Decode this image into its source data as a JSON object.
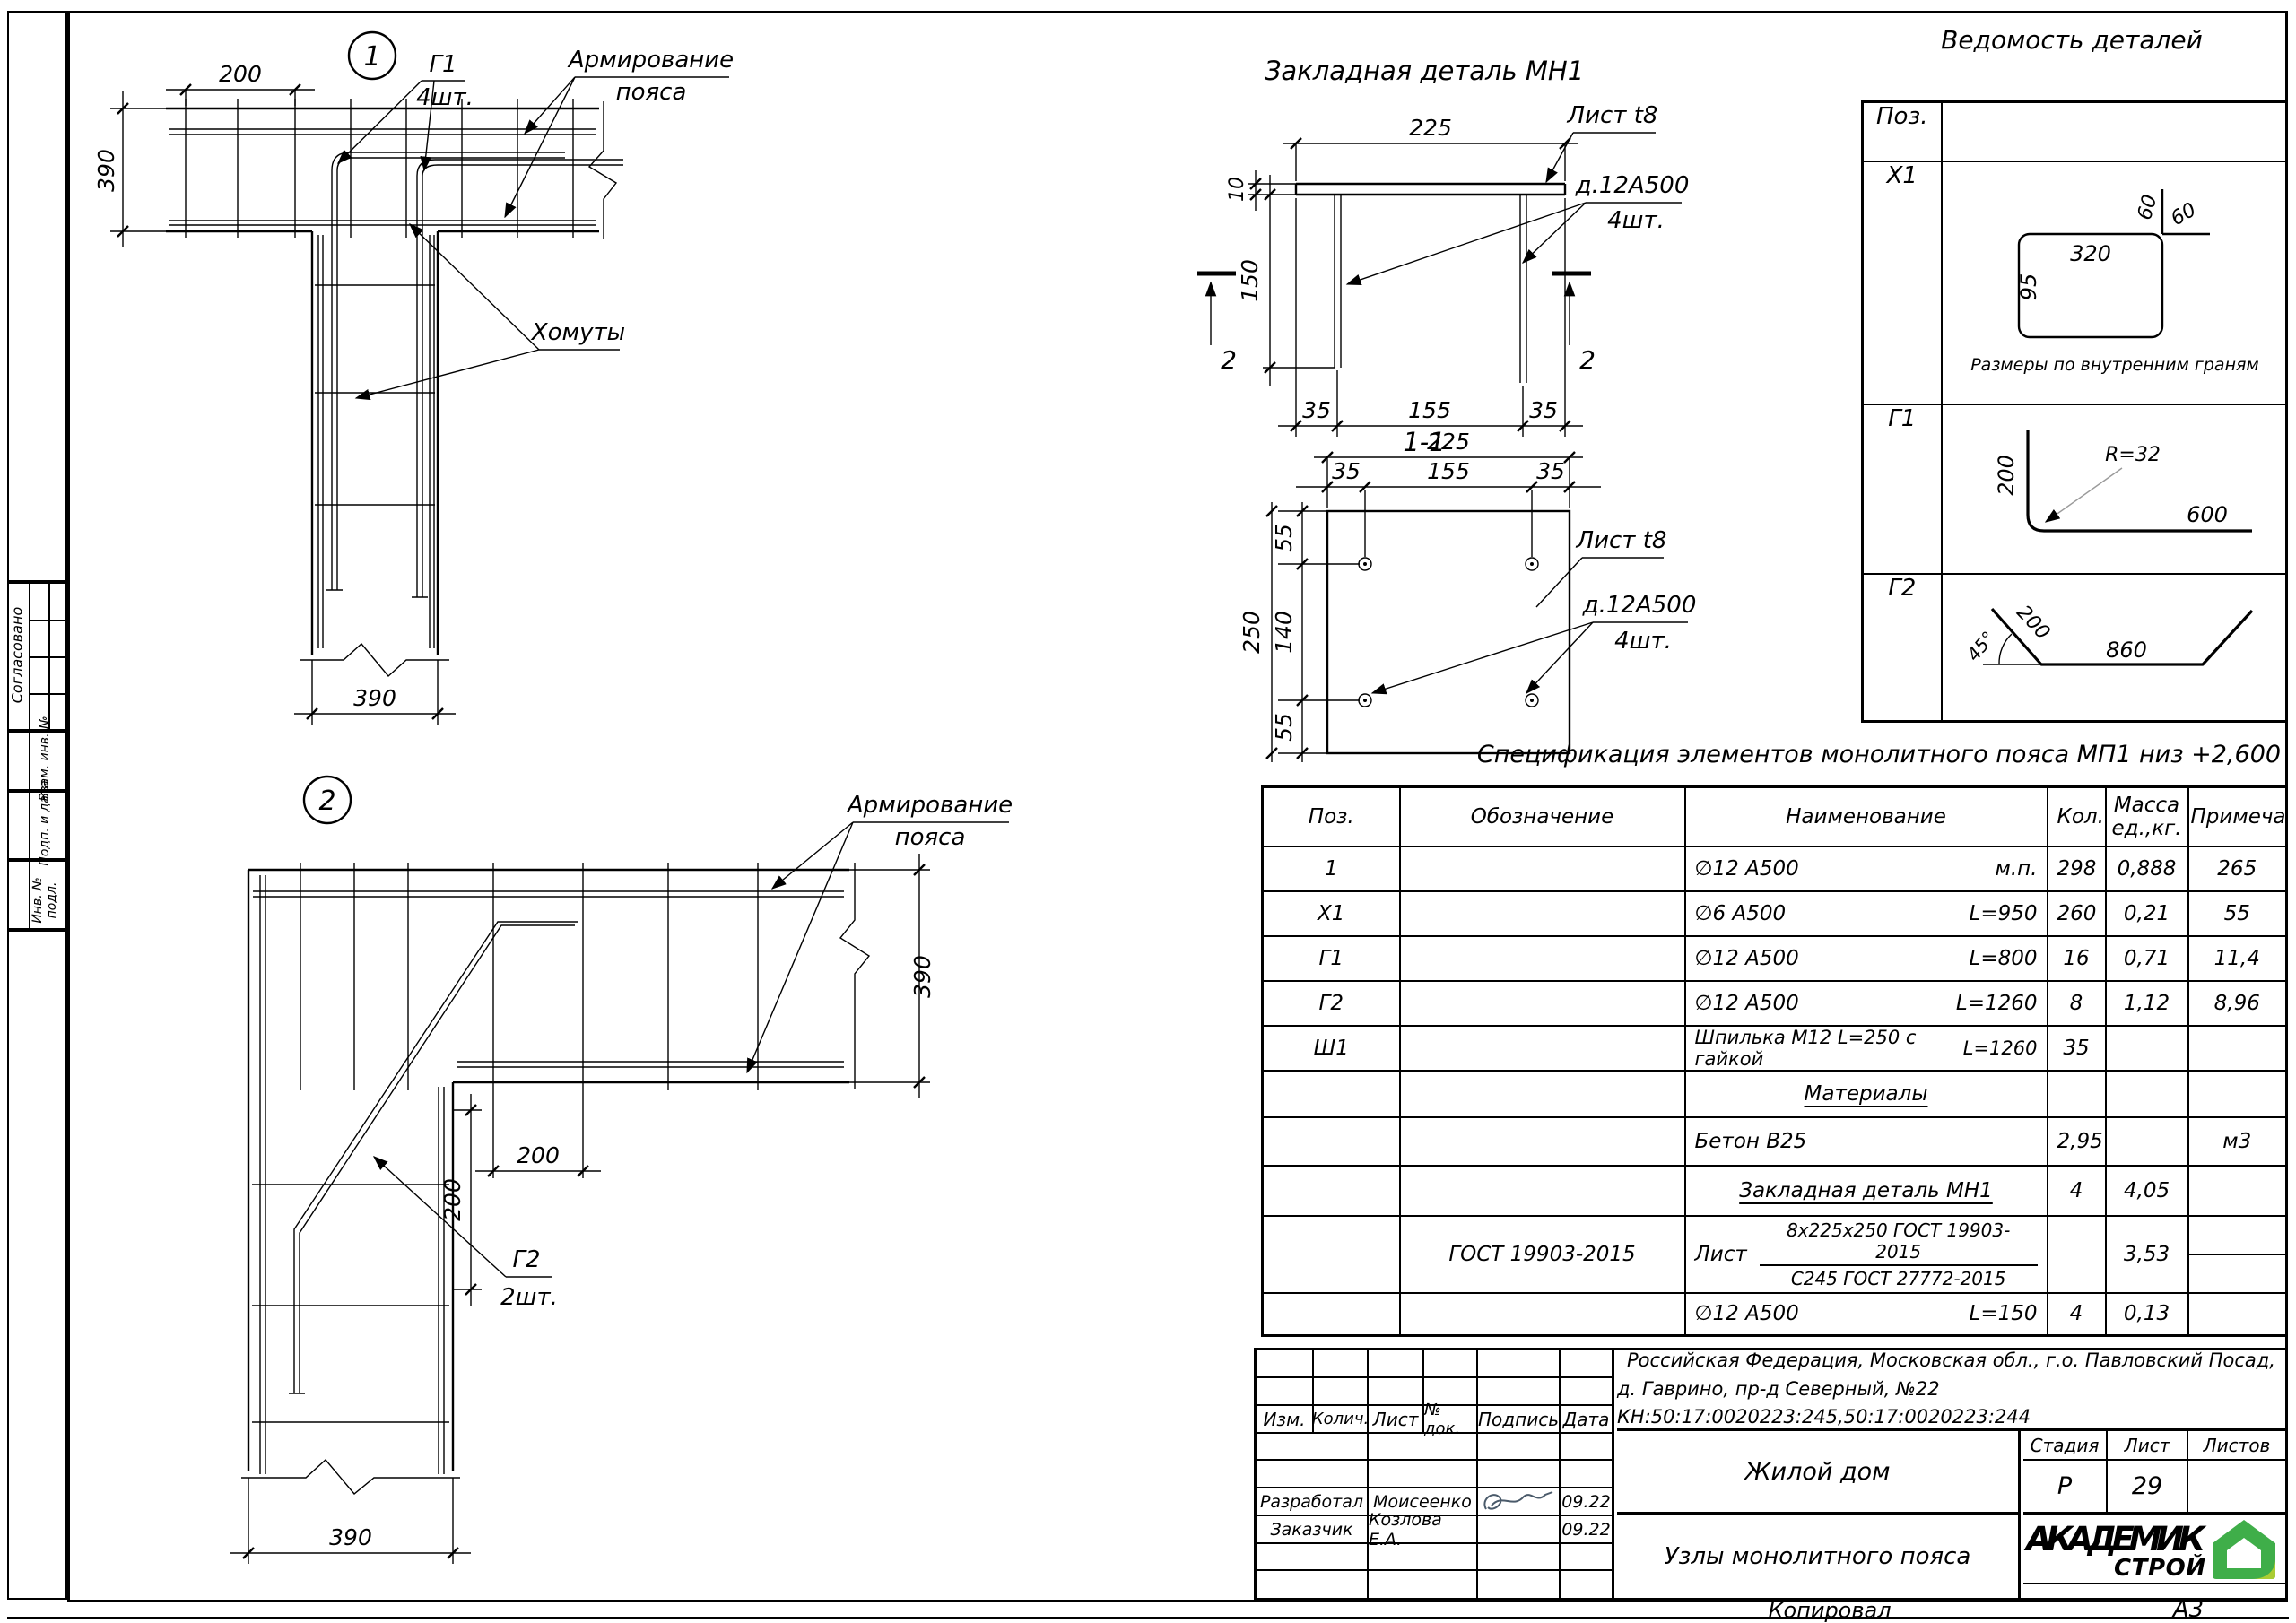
{
  "page": {
    "footer_copied": "Копировал",
    "footer_format": "А3"
  },
  "colors": {
    "line": "#000000",
    "radius_gray": "#9a9a9a",
    "logo_green": "#3fae49",
    "logo_blue": "#1f6fb4",
    "logo_leaf": "#aacc33"
  },
  "sidebar": {
    "approved": "Согласовано",
    "vzam": "Взам. инв. №",
    "podp": "Подп. и дата",
    "inv": "Инв. № подл."
  },
  "detail1": {
    "num": "1",
    "dim_top": "200",
    "dim_left": "390",
    "dim_bottom": "390",
    "g1": "Г1",
    "g1_qty": "4шт.",
    "arm1": "Армирование",
    "arm2": "пояса",
    "khomuty": "Хомуты"
  },
  "detail2": {
    "num": "2",
    "dim_right": "390",
    "dim_bottom": "390",
    "dim_h200": "200",
    "dim_v200": "200",
    "arm1": "Армирование",
    "arm2": "пояса",
    "g2": "Г2",
    "g2_qty": "2шт."
  },
  "mn1": {
    "title": "Закладная деталь МН1",
    "dim225": "225",
    "dim10": "10",
    "dim150": "150",
    "dim35l": "35",
    "dim155": "155",
    "dim35r": "35",
    "list_t8": "Лист t8",
    "rebar": "д.12А500",
    "rebar_qty": "4шт.",
    "sec_mark_l": "2",
    "sec_mark_r": "2",
    "sec_title": "1-1",
    "sec": {
      "dim225": "225",
      "dim35l": "35",
      "dim155": "155",
      "dim35r": "35",
      "dim55t": "55",
      "dim140": "140",
      "dim55b": "55",
      "dim250": "250",
      "list_t8": "Лист t8",
      "rebar": "д.12А500",
      "rebar_qty": "4шт."
    }
  },
  "vedomost": {
    "title": "Ведомость деталей",
    "col_pos": "Поз.",
    "x1": {
      "pos": "Х1",
      "d320": "320",
      "d95": "95",
      "d60a": "60",
      "d60b": "60",
      "caption": "Размеры по внутренним граням"
    },
    "g1": {
      "pos": "Г1",
      "d200": "200",
      "d600": "600",
      "r": "R=32"
    },
    "g2": {
      "pos": "Г2",
      "d45": "45°",
      "d200": "200",
      "d860": "860"
    }
  },
  "spec": {
    "title": "Спецификация элементов монолитного пояса МП1 низ +2,600",
    "h_pos": "Поз.",
    "h_obozn": "Обозначение",
    "h_naim": "Наименование",
    "h_kol": "Кол.",
    "h_massa1": "Масса",
    "h_massa2": "ед.,кг.",
    "h_prim": "Примечание",
    "rows": [
      {
        "pos": "1",
        "obozn": "",
        "name": "∅12 А500",
        "len": "м.п.",
        "kol": "298",
        "massa": "0,888",
        "prim": "265"
      },
      {
        "pos": "Х1",
        "obozn": "",
        "name": "∅6 А500",
        "len": "L=950",
        "kol": "260",
        "massa": "0,21",
        "prim": "55"
      },
      {
        "pos": "Г1",
        "obozn": "",
        "name": "∅12 А500",
        "len": "L=800",
        "kol": "16",
        "massa": "0,71",
        "prim": "11,4"
      },
      {
        "pos": "Г2",
        "obozn": "",
        "name": "∅12 А500",
        "len": "L=1260",
        "kol": "8",
        "massa": "1,12",
        "prim": "8,96"
      },
      {
        "pos": "Ш1",
        "obozn": "",
        "name": "Шпилька М12 L=250 с гайкой",
        "len": "L=1260",
        "kol": "35",
        "massa": "",
        "prim": ""
      },
      {
        "pos": "",
        "obozn": "",
        "name": "Материалы",
        "len": "",
        "kol": "",
        "massa": "",
        "prim": ""
      },
      {
        "pos": "",
        "obozn": "",
        "name": "Бетон В25",
        "len": "",
        "kol": "2,95",
        "massa": "",
        "prim": "м3"
      },
      {
        "pos": "",
        "obozn": "",
        "name": "Закладная деталь МН1",
        "len": "",
        "kol": "4",
        "massa": "4,05",
        "prim": ""
      },
      {
        "pos": "",
        "obozn": "ГОСТ 19903-2015",
        "name": "Лист",
        "frac_top": "8х225х250 ГОСТ 19903-2015",
        "frac_bot": "С245 ГОСТ 27772-2015",
        "kol": "",
        "massa": "3,53",
        "prim": ""
      },
      {
        "pos": "",
        "obozn": "",
        "name": "∅12  А500",
        "len": "L=150",
        "kol": "4",
        "massa": "0,13",
        "prim": ""
      }
    ]
  },
  "titleblock": {
    "address1": "Российская Федерация, Московская обл., г.о. Павловский Посад,",
    "address2": "д. Гаврино, пр-д Северный, №22 КН:50:17:0020223:245,50:17:0020223:244",
    "h_izm": "Изм.",
    "h_kolich": "Колич.",
    "h_list": "Лист",
    "h_doc": "№ док.",
    "h_podpis": "Подпись",
    "h_data": "Дата",
    "dev_label": "Разработал",
    "dev_name": "Моисеенко",
    "dev_date": "09.22",
    "cust_label": "Заказчик",
    "cust_name": "Козлова Е.А.",
    "cust_date": "09.22",
    "object": "Жилой дом",
    "h_stage": "Стадия",
    "h_sheet": "Лист",
    "h_sheets": "Листов",
    "stage": "Р",
    "sheet": "29",
    "sheets": "",
    "title": "Узлы монолитного пояса",
    "logo1": "АКАДЕМИК",
    "logo2": "СТРОЙ"
  }
}
